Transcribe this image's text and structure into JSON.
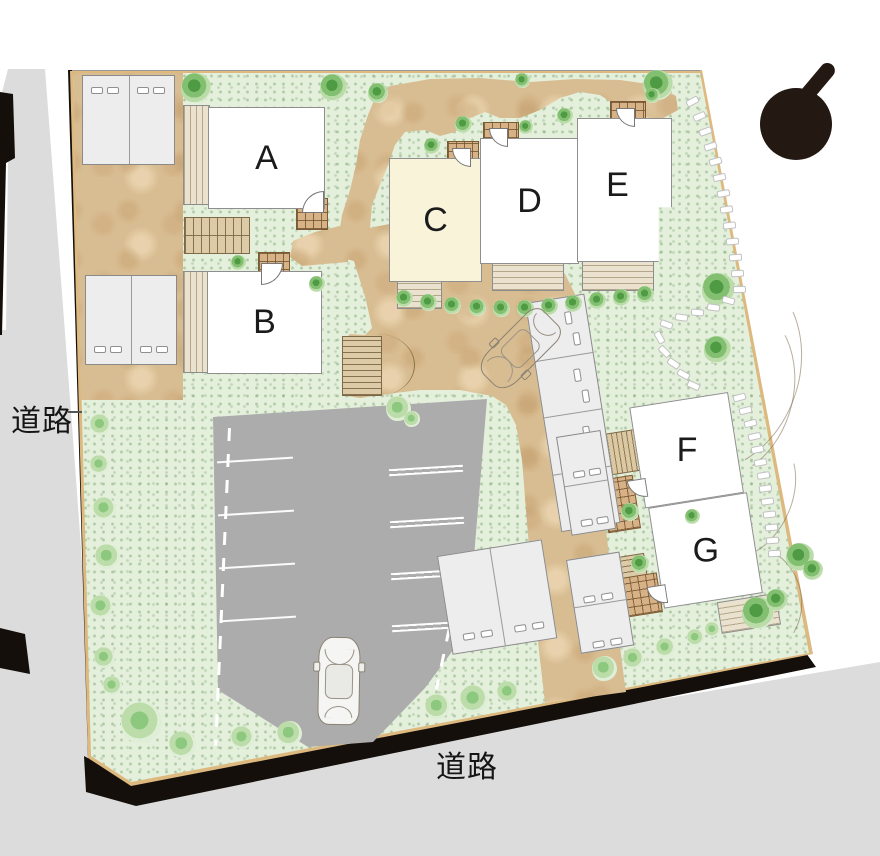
{
  "buildings": [
    {
      "id": "A",
      "label": "A"
    },
    {
      "id": "B",
      "label": "B"
    },
    {
      "id": "C",
      "label": "C"
    },
    {
      "id": "D",
      "label": "D"
    },
    {
      "id": "E",
      "label": "E"
    },
    {
      "id": "F",
      "label": "F"
    },
    {
      "id": "G",
      "label": "G"
    }
  ],
  "roads": {
    "left_label": "道路",
    "bottom_label": "道路"
  },
  "colors": {
    "sand": "#d9bd92",
    "grass": "#e4f0dc",
    "road": "#dcdcdc",
    "parking": "#acacac",
    "curb": "#ddb97f",
    "building": "#ffffff",
    "building_c": "#f8f3d9",
    "shadow": "#140f0b",
    "tree": "#4e9b43",
    "deck": "#eae2cf",
    "porch": "#d8b287",
    "north_mark": "#241813"
  },
  "icons": {
    "north_arrow": "north-arrow-icon",
    "car": "car-icon",
    "tree": "tree-icon",
    "bush": "bush-icon",
    "stepping_stone": "stepping-stone-icon"
  }
}
